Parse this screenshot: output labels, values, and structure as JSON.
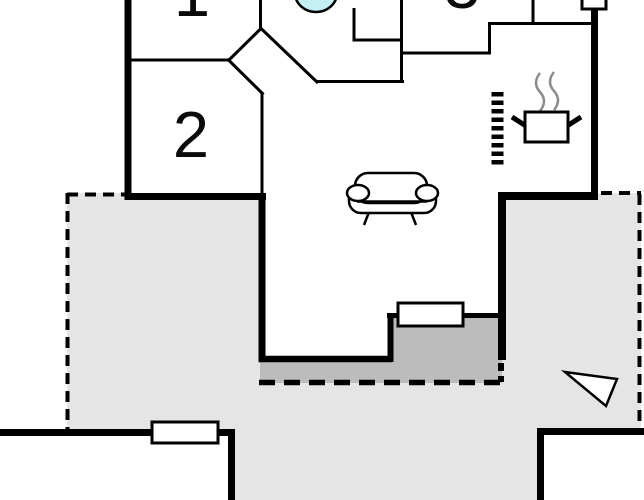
{
  "title": "holiday-home-floor-plan",
  "rooms": [
    {
      "id": "room-1",
      "label": "1"
    },
    {
      "id": "room-2",
      "label": "2"
    },
    {
      "id": "room-3",
      "label": "3"
    }
  ],
  "colors": {
    "terrace": "#e5e5e5",
    "entrance_step": "#bcbcbc",
    "sink": "#c4eff5",
    "wall": "#000000",
    "steam": "#8c8c8c",
    "background": "#ffffff"
  },
  "icons": {
    "sofa": "sofa-icon",
    "stove": "stove-pot-icon",
    "steam": "steam-icon",
    "heater": "heater-icon",
    "sink": "sink-icon",
    "entrance_arrow": "entrance-arrow-icon",
    "chimney": "chimney-icon"
  },
  "features": {
    "terrace": "terrace",
    "entrance_step": "entrance-step",
    "entrance_door": "entrance-door",
    "window": "window",
    "outbuilding_left": "outbuilding-left",
    "outbuilding_right": "outbuilding-right"
  }
}
